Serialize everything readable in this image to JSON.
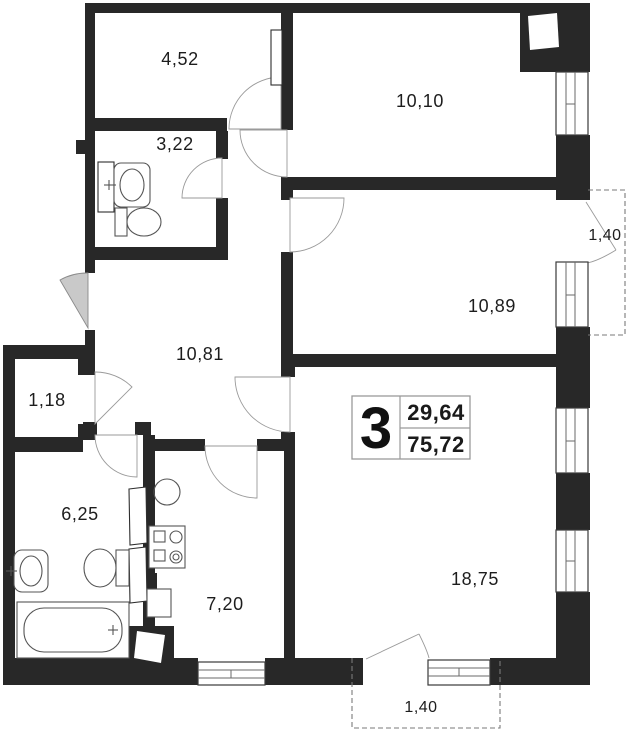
{
  "plan": {
    "unit_badge": {
      "rooms_count": "3",
      "value_top": "29,64",
      "value_bottom": "75,72"
    },
    "rooms": {
      "storage_top": {
        "label": "4,52"
      },
      "wc_small": {
        "label": "3,22"
      },
      "bedroom_top": {
        "label": "10,10"
      },
      "bedroom_right": {
        "label": "10,89"
      },
      "hallway": {
        "label": "10,81"
      },
      "wardrobe": {
        "label": "1,18"
      },
      "bathroom": {
        "label": "6,25"
      },
      "kitchen": {
        "label": "7,20"
      },
      "living_room": {
        "label": "18,75"
      }
    },
    "balconies": {
      "right": {
        "label": "1,40"
      },
      "bottom": {
        "label": "1,40"
      }
    },
    "colors": {
      "wall": "#282828",
      "entrance_swing": "#c9c9c9"
    }
  }
}
